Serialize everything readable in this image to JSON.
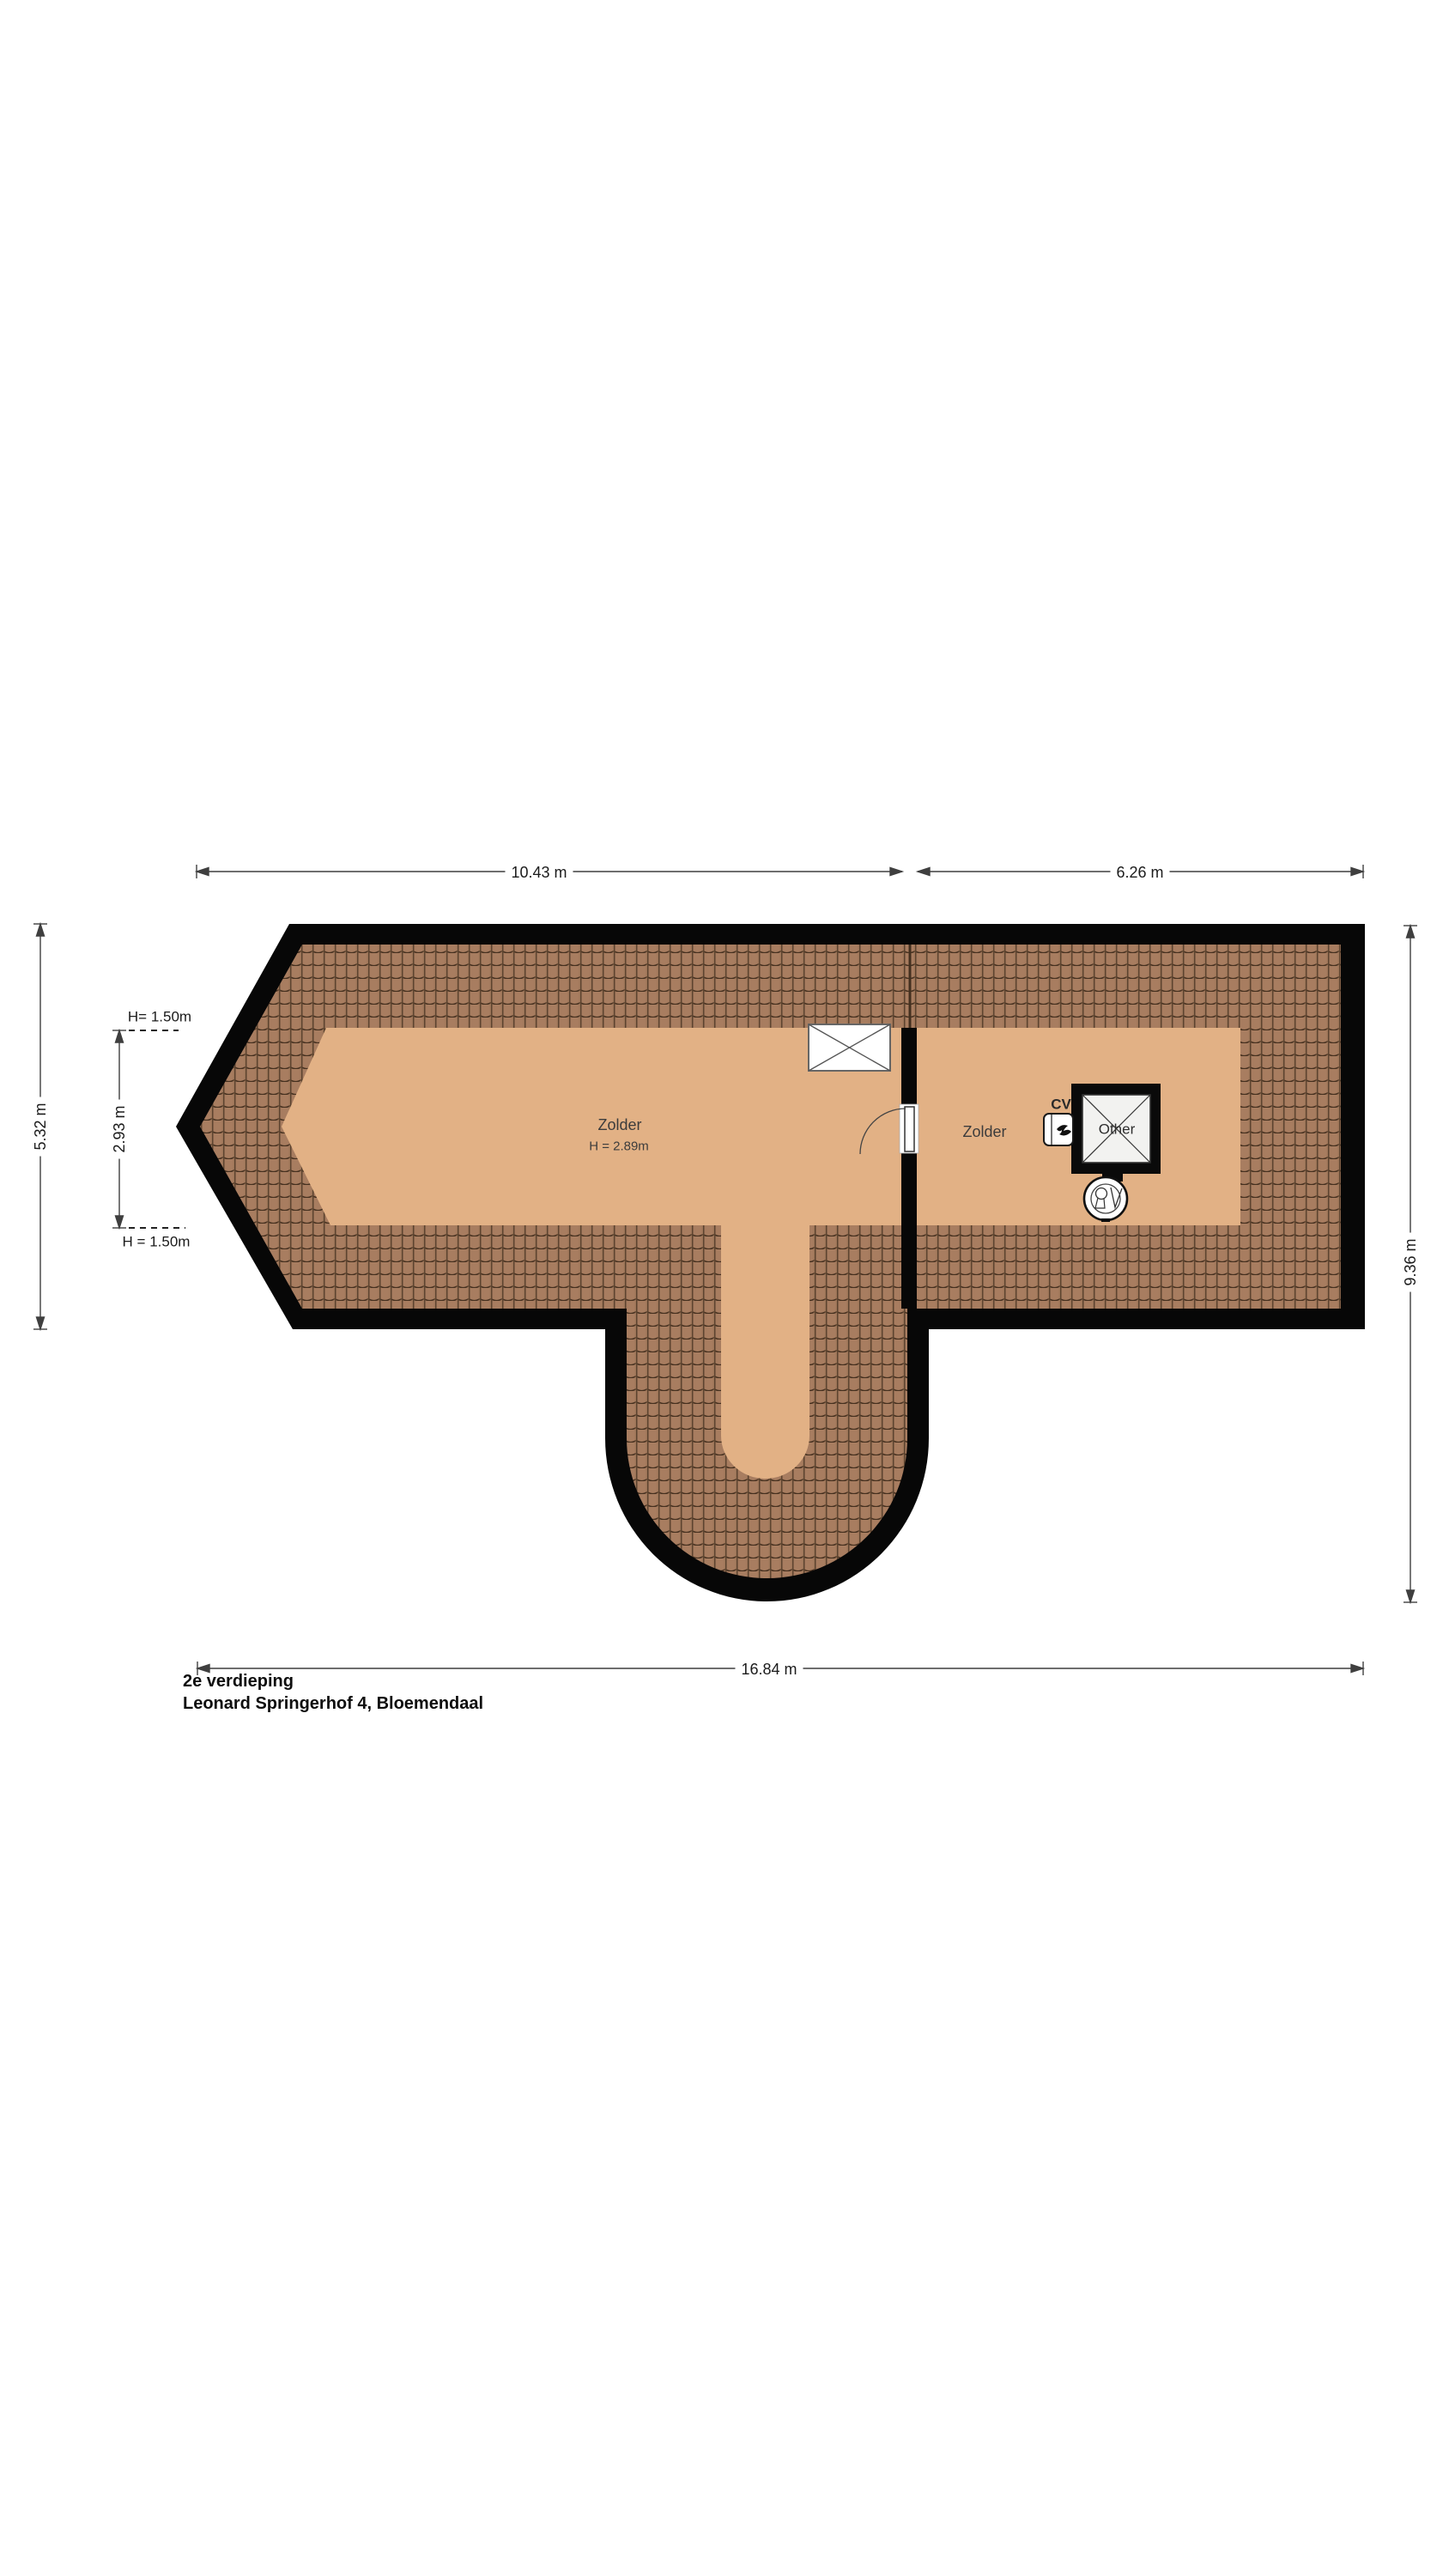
{
  "meta": {
    "floor_title": "2e verdieping",
    "address": "Leonard Springerhof 4, Bloemendaal"
  },
  "rooms": {
    "zolder_left": {
      "label": "Zolder",
      "height_label": "H = 2.89m"
    },
    "zolder_right": {
      "label": "Zolder"
    }
  },
  "fixtures": {
    "shaft_label": "Other",
    "cv_label": "CV"
  },
  "dimensions": {
    "top_left": "10.43 m",
    "top_right": "6.26 m",
    "bottom": "16.84 m",
    "left_outer": "5.32 m",
    "left_inner": "2.93 m",
    "right": "9.36 m",
    "height_line_top": "H= 1.50m",
    "height_line_bottom": "H = 1.50m"
  },
  "colors": {
    "floor": "#E2B185",
    "roof_tile": "#A87D60",
    "roof_tile_line": "#45301F",
    "outline": "#070707",
    "dimension_line": "#3F3F3F",
    "background": "#FFFFFF"
  }
}
